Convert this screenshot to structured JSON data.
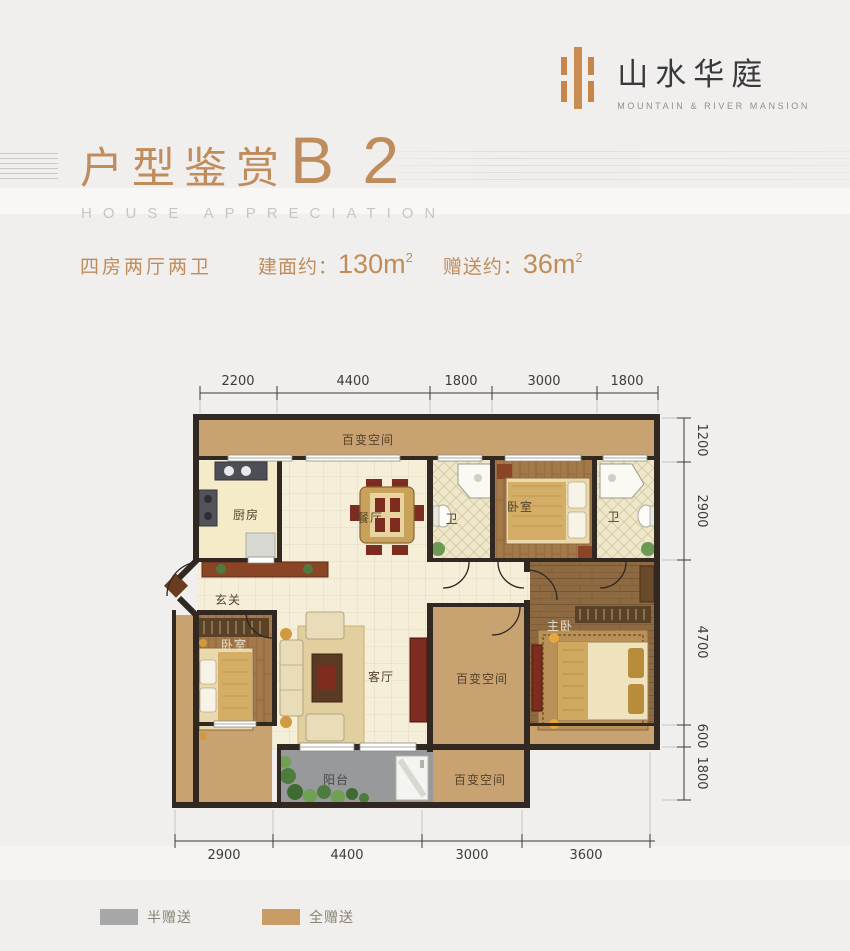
{
  "brand": {
    "name": "山水华庭",
    "tagline": "MOUNTAIN & RIVER MANSION"
  },
  "header": {
    "title": "户型鉴赏",
    "unit": "B 2",
    "subtitle": "HOUSE APPRECIATION"
  },
  "specs": {
    "layout": "四房两厅两卫",
    "area_label": "建面约：",
    "area_value": "130m",
    "area_sup": "2",
    "gift_label": "赠送约：",
    "gift_value": "36m",
    "gift_sup": "2"
  },
  "floorplan": {
    "rooms": {
      "flex_top": "百变空间",
      "kitchen": "厨房",
      "dining": "餐厅",
      "bath_left": "卫",
      "bedroom_top": "卧室",
      "bath_right": "卫",
      "foyer": "玄关",
      "bedroom_left": "卧室",
      "living": "客厅",
      "flex_mid": "百变空间",
      "master": "主卧",
      "balcony": "阳台",
      "flex_bottom": "百变空间"
    },
    "dimensions": {
      "top": [
        "2200",
        "4400",
        "1800",
        "3000",
        "1800"
      ],
      "right": [
        "1200",
        "2900",
        "4700",
        "600",
        "1800"
      ],
      "bottom": [
        "2900",
        "4400",
        "3000",
        "3600"
      ]
    }
  },
  "legend": {
    "half": "半赠送",
    "full": "全赠送"
  },
  "colors": {
    "accent": "#bf8c5c",
    "logo_orange": "#c8854a",
    "gift_full": "#c99c66",
    "gift_half": "#a7a7a7",
    "wall": "#312921"
  }
}
